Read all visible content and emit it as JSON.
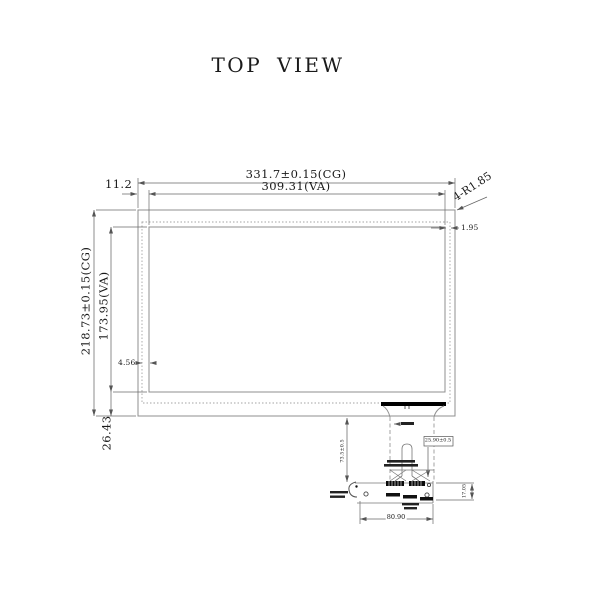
{
  "drawing": {
    "title": "TOP VIEW",
    "dimensions": {
      "cg_width": "331.7±0.15(CG)",
      "va_width": "309.31(VA)",
      "left_offset": "11.2",
      "corner_radius": "4-R1.85",
      "right_border": "1.95",
      "left_border": "4.56",
      "cg_height": "218.73±0.15(CG)",
      "va_height": "173.95(VA)",
      "bottom_offset": "26.43",
      "fpc_length": "73.5±0.5",
      "fpc_width_boxed": "25.90±0.5",
      "connector_height": "17.05",
      "connector_width": "80.90"
    }
  }
}
